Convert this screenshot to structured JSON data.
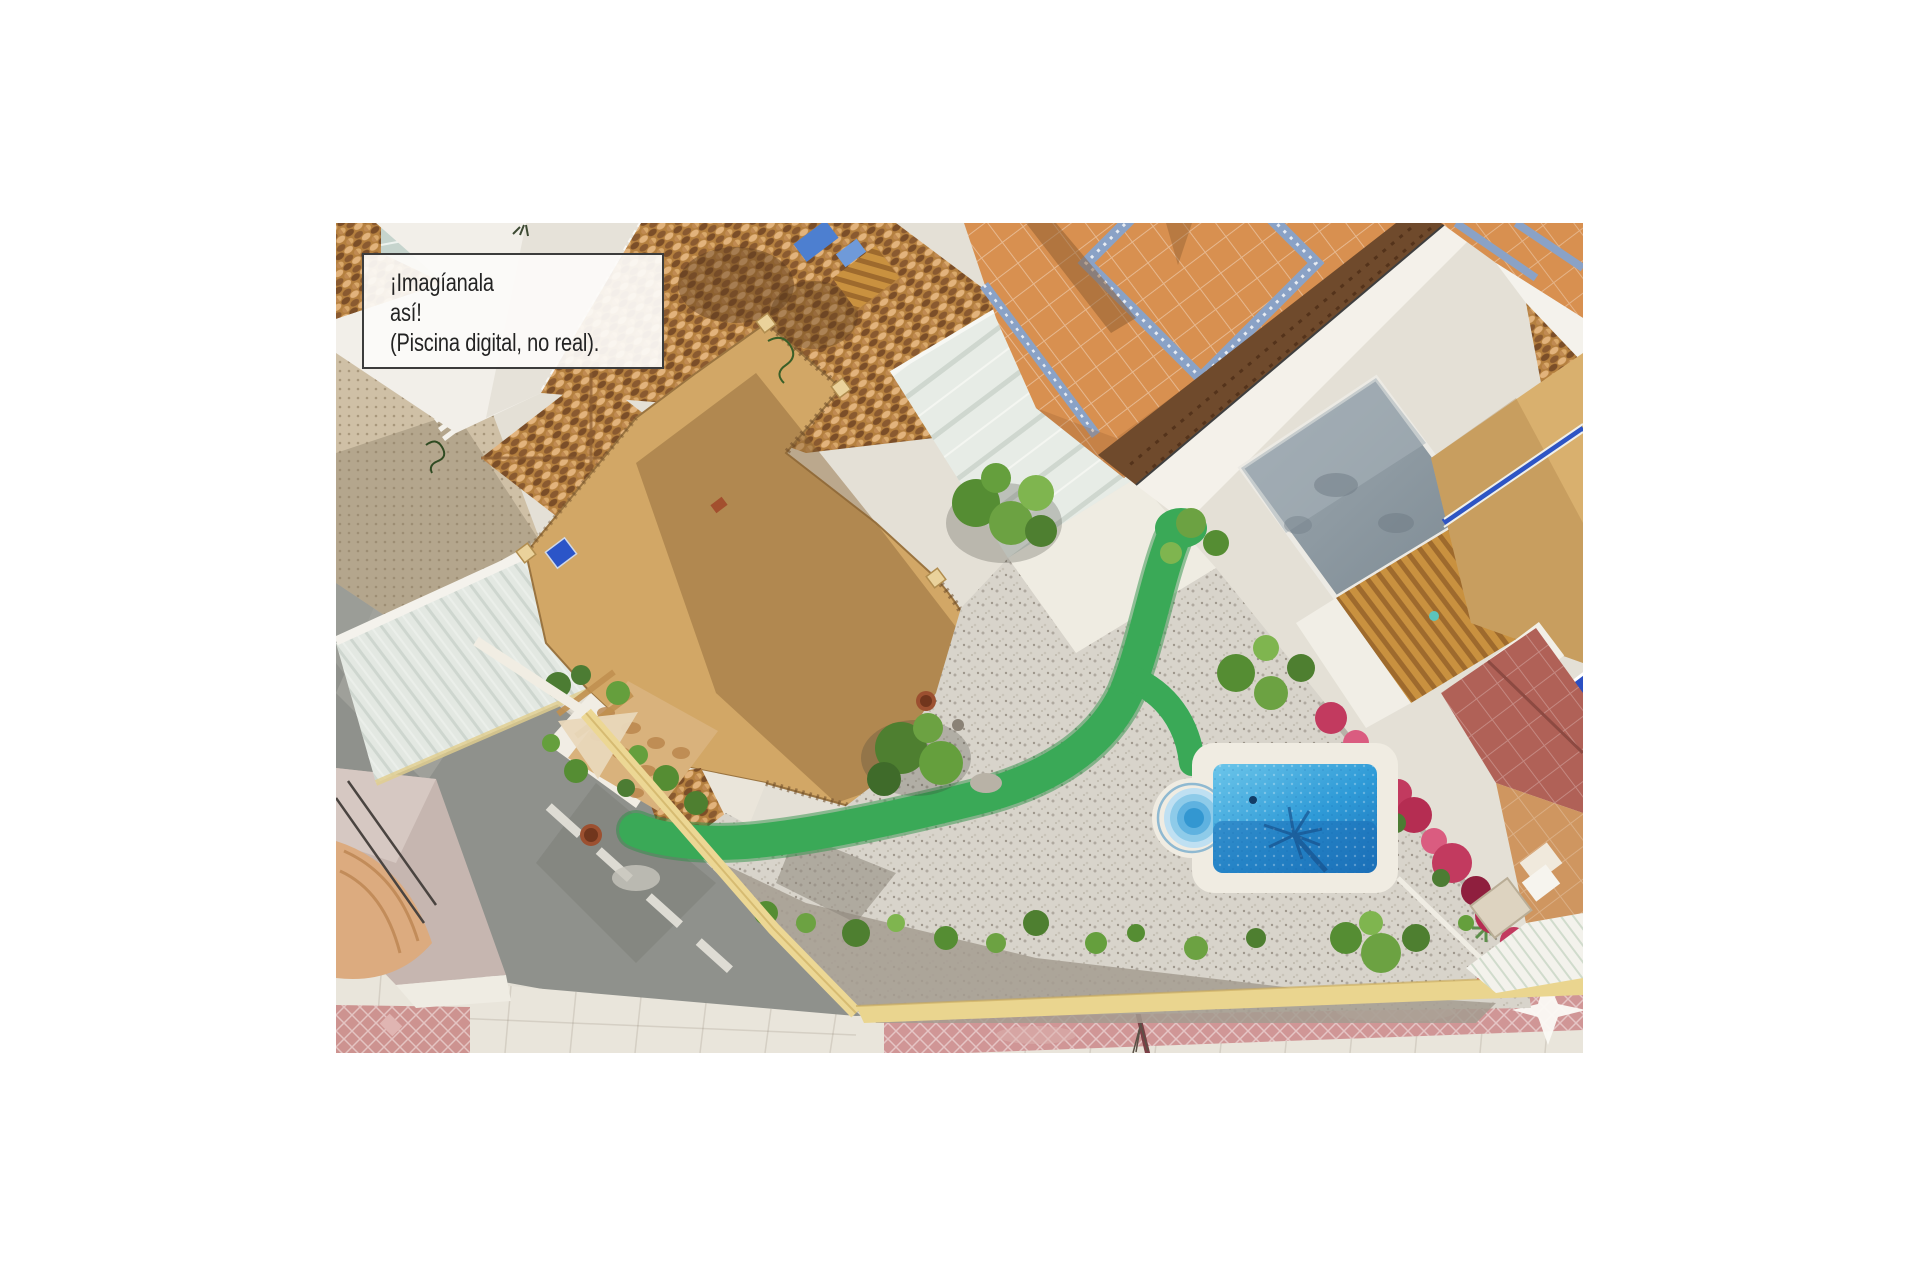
{
  "caption": {
    "line1": "¡Imagíanala",
    "line2": "así!",
    "line3": "(Piscina digital, no real)."
  },
  "scene": {
    "type": "aerial-drone-photo-of-villa-with-digitally-added-pool",
    "colors": {
      "page_background": "#ffffff",
      "caption_background": "#fcfbf9",
      "caption_border": "#3c3c3c",
      "caption_text": "#232323",
      "terracotta_roof": "#b5803f",
      "terrace_tan": "#d2a766",
      "orange_patio": "#d89050",
      "mosaic_blue": "#8aa2c6",
      "pool_water_light": "#6cc6ea",
      "pool_water_dark": "#1c73ba",
      "pool_coping": "#f0ece2",
      "turf_green": "#3aa957",
      "bougainvillea_red": "#c23a5f",
      "gravel": "#d8d4cb",
      "road_asphalt": "#8f918c",
      "sidewalk_red_tiles": "#cd9390",
      "sidewalk_cream": "#e9e5db",
      "boundary_wall_yellow": "#ecd794",
      "cobalt_lounger_blue": "#2b4fc2",
      "maroon_roof": "#b06157",
      "gray_roof": "#93a0a8"
    }
  }
}
